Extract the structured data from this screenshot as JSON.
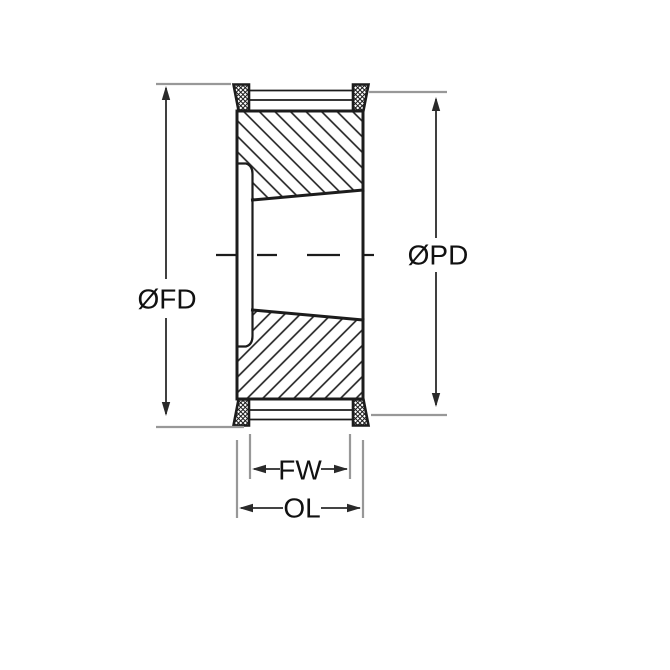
{
  "drawing": {
    "type": "technical-cross-section",
    "subject": "timing pulley with taper bore and flanges",
    "labels": {
      "fd": "ØFD",
      "pd": "ØPD",
      "fw": "FW",
      "ol": "OL"
    },
    "colors": {
      "line": "#1c1c1c",
      "dimension_line": "#2a2a2a",
      "extension_line": "#989898",
      "background": "#ffffff"
    }
  }
}
